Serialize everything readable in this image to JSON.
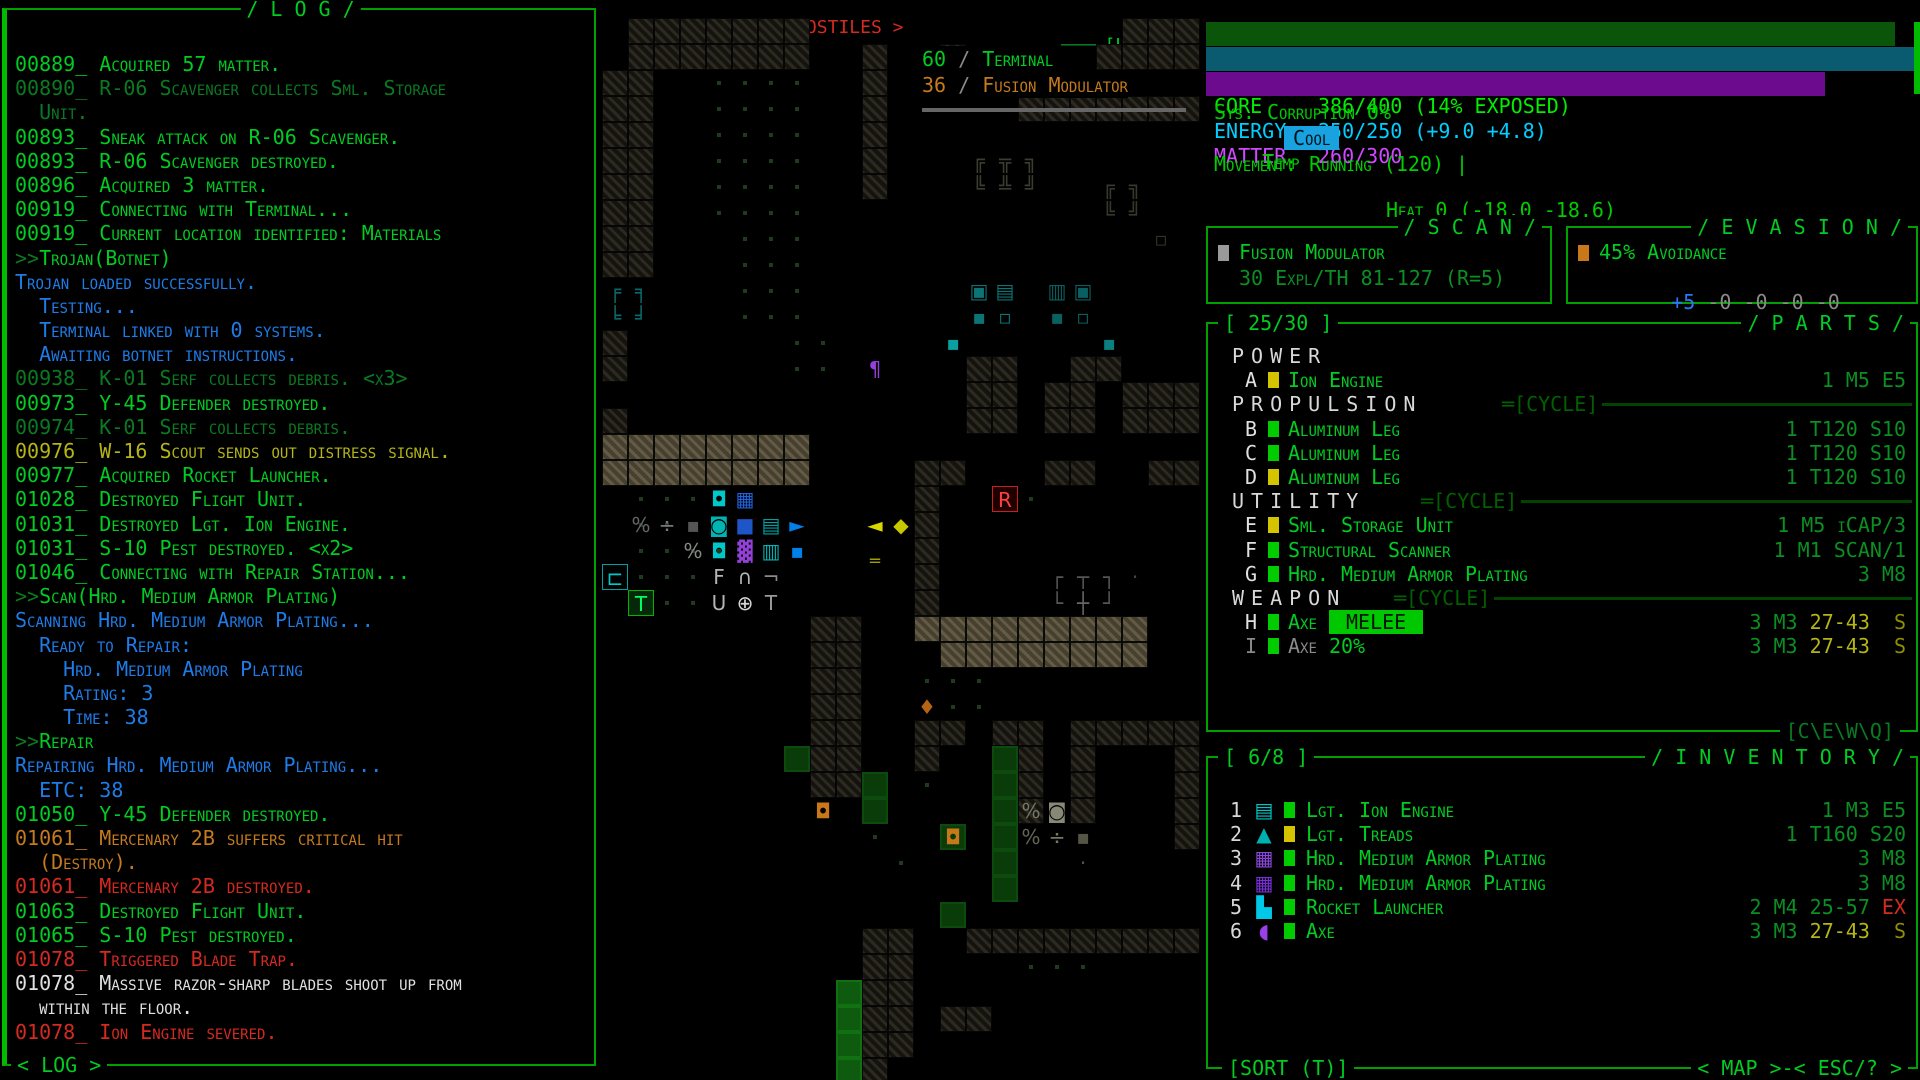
{
  "colors": {
    "green_bright": "#00cc22",
    "green_dim": "#0a7a22",
    "green_border": "#00a000",
    "blue": "#1e7ce8",
    "yellow": "#b5b517",
    "orange": "#c57a1e",
    "red": "#d42a20",
    "white": "#e0e0e0",
    "cyan": "#00c8c8",
    "purple": "#9340d8",
    "core_bar": "#0b550b",
    "energy_bar": "#0a5a70",
    "matter_bar": "#6d0b8e",
    "temp_chip_bg": "#18a2e0",
    "melee_chip_bg": "#00c800"
  },
  "log": {
    "title": "/ L O G /",
    "footer": "< LOG >",
    "lines": [
      [
        [
          "00889_ Acquired 57 matter.",
          "g"
        ]
      ],
      [
        [
          "00890_ R-06 Scavenger collects Sml. Storage",
          "d"
        ]
      ],
      [
        [
          "  Unit.",
          "d"
        ]
      ],
      [
        [
          "00893_ Sneak attack on R-06 Scavenger.",
          "g"
        ]
      ],
      [
        [
          "00893_ R-06 Scavenger destroyed.",
          "g"
        ]
      ],
      [
        [
          "00896_ Acquired 3 matter.",
          "g"
        ]
      ],
      [
        [
          "00919_ Connecting with Terminal...",
          "g"
        ]
      ],
      [
        [
          "00919_ Current location identified: Materials",
          "g"
        ]
      ],
      [
        [
          ">>",
          "d"
        ],
        [
          "Trojan(Botnet)",
          "g"
        ]
      ],
      [
        [
          "Trojan loaded successfully.",
          "b"
        ]
      ],
      [
        [
          "  Testing...",
          "b"
        ]
      ],
      [
        [
          "  Terminal linked with 0 systems.",
          "b"
        ]
      ],
      [
        [
          "  Awaiting botnet instructions.",
          "b"
        ]
      ],
      [
        [
          "00938_ K-01 Serf collects debris. <x3>",
          "d"
        ]
      ],
      [
        [
          "00973_ Y-45 Defender destroyed.",
          "g"
        ]
      ],
      [
        [
          "00974_ K-01 Serf collects debris.",
          "d"
        ]
      ],
      [
        [
          "00976_ W-16 Scout sends out distress signal.",
          "y"
        ]
      ],
      [
        [
          "00977_ Acquired Rocket Launcher.",
          "g"
        ]
      ],
      [
        [
          "01028_ Destroyed Flight Unit.",
          "g"
        ]
      ],
      [
        [
          "01031_ Destroyed Lgt. Ion Engine.",
          "g"
        ]
      ],
      [
        [
          "01031_ S-10 Pest destroyed. <x2>",
          "g"
        ]
      ],
      [
        [
          "01046_ Connecting with Repair Station...",
          "g"
        ]
      ],
      [
        [
          ">>",
          "d"
        ],
        [
          "Scan(Hrd. Medium Armor Plating)",
          "g"
        ]
      ],
      [
        [
          "Scanning Hrd. Medium Armor Plating...",
          "b"
        ]
      ],
      [
        [
          "  Ready to Repair:",
          "b"
        ]
      ],
      [
        [
          "    Hrd. Medium Armor Plating",
          "b"
        ]
      ],
      [
        [
          "    Rating: 3",
          "b"
        ]
      ],
      [
        [
          "    Time: 38",
          "b"
        ]
      ],
      [
        [
          ">>",
          "d"
        ],
        [
          "Repair",
          "g"
        ]
      ],
      [
        [
          "Repairing Hrd. Medium Armor Plating...",
          "b"
        ]
      ],
      [
        [
          "  ETC: 38",
          "b"
        ]
      ],
      [
        [
          "01050_ Y-45 Defender destroyed.",
          "g"
        ]
      ],
      [
        [
          "01061_ Mercenary 2B suffers critical hit",
          "o"
        ]
      ],
      [
        [
          "  (Destroy).",
          "o"
        ]
      ],
      [
        [
          "01061_ Mercenary 2B destroyed.",
          "r"
        ]
      ],
      [
        [
          "01063_ Destroyed Flight Unit.",
          "g"
        ]
      ],
      [
        [
          "01065_ S-10 Pest destroyed.",
          "g"
        ]
      ],
      [
        [
          "01078_ Triggered Blade Trap.",
          "r"
        ]
      ],
      [
        [
          "01078_ Massive razor-sharp blades shoot up from",
          "w"
        ]
      ],
      [
        [
          "  within the floor.",
          "w"
        ]
      ],
      [
        [
          "01078_ Ion Engine severed.",
          "r"
        ]
      ]
    ]
  },
  "map": {
    "header": {
      "zoom": "< ZOOM >",
      "dash": "-",
      "hostiles": "< 2 HOSTILES >",
      "laic": "[L\\A\\I\\C]"
    },
    "labels": {
      "terminal_num": "60",
      "slash1": "/",
      "terminal": "Terminal",
      "fusion_num": "36",
      "slash2": "/",
      "fusion": "Fusion Modulator"
    },
    "tiles": {
      "legend": {
        "#": "wall",
        "%": "wall-bright",
        ".": "floor-dot",
        "g": "green-tile",
        "G": "green-tile-bright"
      },
      "rows": [
        " #######            ###",
        " #######  #  #     ####",
        "##  ....  #            ",
        "##  ....  #     #######",
        "##  ....  #            ",
        "##  ....  #            ",
        "##  ....  #            ",
        "##  ....               ",
        "##   ...               ",
        "##   ...               ",
        "     ...               ",
        "     ...               ",
        "#      ..              ",
        "#      ..     ##  ##   ",
        "              ## ## ###",
        "#             ## ## ###",
        "%%%%%%%%               ",
        "%%%%%%%%    ##   ##  ##",
        " ...        #   .      ",
        " ....       #          ",
        " ....       #          ",
        " ...        #          ",
        "  ..        #          ",
        "        ##  %%%%%%%%%  ",
        "        ##   %%%%%%%%  ",
        "        ##  ...        ",
        "        ##  ...        ",
        "        ##  ## ## #####",
        "       g##  #  g# #   #",
        "        ##g .  g# #   #",
        "          g    g#.#   #",
        "          .  g g      #",
        "           .   g       ",
        "               g       ",
        "             g         ",
        "          ##  #########",
        "          ##    ...    ",
        "         G##           ",
        "         G## ##        ",
        "         G##           ",
        "         G#            "
      ]
    },
    "entities": [
      [
        14,
        5,
        "╔",
        "#3c3c30"
      ],
      [
        15,
        5,
        "╦",
        "#3c3c30"
      ],
      [
        16,
        5,
        "╗",
        "#3c3c30"
      ],
      [
        14,
        6,
        "╚",
        "#3c3c30"
      ],
      [
        15,
        6,
        "╩",
        "#3c3c30"
      ],
      [
        16,
        6,
        "╝",
        "#3c3c30"
      ],
      [
        19,
        6,
        "╔",
        "#38382c"
      ],
      [
        20,
        6,
        "╗",
        "#38382c"
      ],
      [
        19,
        7,
        "╚",
        "#38382c"
      ],
      [
        20,
        7,
        "╝",
        "#38382c"
      ],
      [
        21,
        8,
        "▫",
        "#33332a"
      ],
      [
        0,
        10,
        "╒",
        "#0b6868"
      ],
      [
        1,
        10,
        "╕",
        "#0b6868"
      ],
      [
        0,
        11,
        "╘",
        "#0b6868"
      ],
      [
        1,
        11,
        "╛",
        "#0b6868"
      ],
      [
        14,
        10,
        "▣",
        "#0c7474"
      ],
      [
        15,
        10,
        "▤",
        "#0c7474"
      ],
      [
        17,
        10,
        "▥",
        "#0a6060"
      ],
      [
        18,
        10,
        "▣",
        "#0a6060"
      ],
      [
        14,
        11,
        "▪",
        "#0c7474"
      ],
      [
        15,
        11,
        "▫",
        "#0c7474"
      ],
      [
        17,
        11,
        "▪",
        "#0a6060"
      ],
      [
        18,
        11,
        "▫",
        "#0a6060"
      ],
      [
        19,
        12,
        "▪",
        "#0b8080"
      ],
      [
        13,
        12,
        "▪",
        "#0aa0a0"
      ],
      [
        10,
        13,
        "¶",
        "#9340d8"
      ],
      [
        1,
        19,
        "%",
        "#666666"
      ],
      [
        2,
        19,
        "÷",
        "#777777"
      ],
      [
        3,
        19,
        "▪",
        "#555555"
      ],
      [
        4,
        18,
        "◘",
        "#00c8c8"
      ],
      [
        5,
        18,
        "▦",
        "#2060d8"
      ],
      [
        4,
        19,
        "◙",
        "#00b4b4"
      ],
      [
        5,
        19,
        "■",
        "#1e56c8"
      ],
      [
        6,
        19,
        "▤",
        "#00a0a0"
      ],
      [
        7,
        19,
        "►",
        "#0080e8"
      ],
      [
        3,
        20,
        "%",
        "#888888"
      ],
      [
        4,
        20,
        "◘",
        "#00c8c8"
      ],
      [
        5,
        20,
        "▓",
        "#9340d8"
      ],
      [
        6,
        20,
        "▥",
        "#00b4b4"
      ],
      [
        7,
        20,
        "▪",
        "#0080e8"
      ],
      [
        10,
        19,
        "◄",
        "#d8d800"
      ],
      [
        11,
        19,
        "◆",
        "#c8c800"
      ],
      [
        10,
        20,
        "‗",
        "#a0a000"
      ],
      [
        15,
        18,
        "R",
        "#ff4040",
        "#1e0000",
        "#c82020",
        "hostile-robot"
      ],
      [
        0,
        21,
        "⊏",
        "#00c8c8",
        null,
        "#00a0a0",
        "machine-access-tile"
      ],
      [
        1,
        22,
        "T",
        "#00ff60",
        "#06280a",
        "#00b400",
        "terminal-tile"
      ],
      [
        4,
        21,
        "F",
        "#b4b4b4"
      ],
      [
        5,
        21,
        "∩",
        "#b4b4b4"
      ],
      [
        6,
        21,
        "¬",
        "#8a8a8a"
      ],
      [
        4,
        22,
        "U",
        "#b4b4b4"
      ],
      [
        5,
        22,
        "⊕",
        "#d8d8d8",
        null,
        null,
        "targeting-cursor"
      ],
      [
        6,
        22,
        "T",
        "#9a9a9a"
      ],
      [
        17,
        21,
        "┌",
        "#555555"
      ],
      [
        18,
        21,
        "┬",
        "#555555"
      ],
      [
        19,
        21,
        "┐",
        "#555555"
      ],
      [
        20,
        21,
        "·",
        "#444444"
      ],
      [
        17,
        22,
        "└",
        "#555555"
      ],
      [
        18,
        22,
        "┼",
        "#666666"
      ],
      [
        19,
        22,
        "┘",
        "#555555"
      ],
      [
        12,
        26,
        "♦",
        "#b46414"
      ],
      [
        8,
        30,
        "◘",
        "#c87818"
      ],
      [
        13,
        31,
        "◘",
        "#c87818"
      ],
      [
        16,
        30,
        "%",
        "#777766"
      ],
      [
        17,
        30,
        "◙",
        "#888877"
      ],
      [
        16,
        31,
        "%",
        "#666655"
      ],
      [
        17,
        31,
        "÷",
        "#777766"
      ],
      [
        18,
        31,
        "▪",
        "#555544"
      ],
      [
        18,
        32,
        "·",
        "#555544"
      ]
    ]
  },
  "status": {
    "core_label": "CORE",
    "core_value": "386/400 (14% EXPOSED)",
    "core_fill_pct": 96.5,
    "energy_label": "ENERGY",
    "energy_value": "250/250 (+9.0 +4.8)",
    "energy_fill_pct": 100,
    "matter_label": "MATTER",
    "matter_value": "260/300",
    "matter_fill_pct": 86.7,
    "sys": "Sys. Corruption 0%",
    "temp_label": "Temp",
    "temp_chip": "Cool",
    "temp_rest": "Heat 0 (-18.0 -18.6)",
    "movement": "Movement: Running (120) |",
    "time_label": "Time:",
    "time_value": "1144",
    "loc_label": "Loc:",
    "loc_value": "-9/Materials"
  },
  "scan": {
    "title": "/ S C A N /",
    "item": "Fusion Modulator",
    "detail": "30 Expl/TH 81-127 (R=5)"
  },
  "evasion": {
    "title": "/ E V A S I O N /",
    "line1": "45% Avoidance",
    "plus": "+5",
    "minuses": " -0 -0 -0 -0"
  },
  "parts": {
    "count": "[ 25/30 ]",
    "title": "/ P A R T S /",
    "footer": "[C\\E\\W\\Q]",
    "rows": [
      {
        "type": "section",
        "label": "POWER",
        "cycle": ""
      },
      {
        "type": "item",
        "slot": "A",
        "slot_c": "w",
        "block": "#d4c400",
        "name": [
          [
            "Ion Engine",
            "g"
          ]
        ],
        "stats": [
          [
            "1 M5 E5",
            "s"
          ]
        ]
      },
      {
        "type": "section",
        "label": "PROPULSION",
        "cycle": "═[CYCLE]"
      },
      {
        "type": "item",
        "slot": "B",
        "slot_c": "w",
        "block": "#00cc00",
        "name": [
          [
            "Aluminum Leg",
            "g"
          ]
        ],
        "stats": [
          [
            "1 T120 S10",
            "s"
          ]
        ]
      },
      {
        "type": "item",
        "slot": "C",
        "slot_c": "w",
        "block": "#00cc00",
        "name": [
          [
            "Aluminum Leg",
            "g"
          ]
        ],
        "stats": [
          [
            "1 T120 S10",
            "s"
          ]
        ]
      },
      {
        "type": "item",
        "slot": "D",
        "slot_c": "w",
        "block": "#d4c400",
        "name": [
          [
            "Aluminum Leg",
            "g"
          ]
        ],
        "stats": [
          [
            "1 T120 S10",
            "s"
          ]
        ]
      },
      {
        "type": "section",
        "label": "UTILITY",
        "cycle": "═[CYCLE]"
      },
      {
        "type": "item",
        "slot": "E",
        "slot_c": "w",
        "block": "#d4c400",
        "name": [
          [
            "Sml. Storage Unit",
            "g"
          ]
        ],
        "stats": [
          [
            "1 M5 iCAP/3",
            "s"
          ]
        ]
      },
      {
        "type": "item",
        "slot": "F",
        "slot_c": "w",
        "block": "#00cc00",
        "name": [
          [
            "Structural Scanner",
            "g"
          ]
        ],
        "stats": [
          [
            "1 M1 SCAN/1",
            "s"
          ]
        ]
      },
      {
        "type": "item",
        "slot": "G",
        "slot_c": "w",
        "block": "#00cc00",
        "name": [
          [
            "Hrd. Medium Armor Plating",
            "g"
          ]
        ],
        "stats": [
          [
            "3 M8",
            "s"
          ]
        ]
      },
      {
        "type": "section",
        "label": "WEAPON",
        "cycle": "═[CYCLE]"
      },
      {
        "type": "item",
        "slot": "H",
        "slot_c": "w",
        "block": "#00cc00",
        "name": [
          [
            "Axe ",
            "g"
          ],
          [
            " MELEE ",
            "chip"
          ]
        ],
        "stats": [
          [
            "3 M3 ",
            "s"
          ],
          [
            "27-43",
            "y"
          ],
          [
            "  S",
            "dy"
          ]
        ]
      },
      {
        "type": "item",
        "slot": "I",
        "slot_c": "gr",
        "block": "#00cc00",
        "name": [
          [
            "Axe ",
            "gr"
          ],
          [
            "20%",
            "g"
          ]
        ],
        "stats": [
          [
            "3 M3 ",
            "s"
          ],
          [
            "27-43",
            "y"
          ],
          [
            "  S",
            "dy"
          ]
        ]
      }
    ]
  },
  "inventory": {
    "count": "[ 6/8 ]",
    "title": "/ I N V E N T O R Y /",
    "footer_left": "[SORT (T)]",
    "footer_right": "< MAP >-< ESC/? >",
    "rows": [
      {
        "num": "1",
        "icon": "▤",
        "icon_c": "#00c8c8",
        "icon_name": "ion-engine-icon",
        "block": "#00cc00",
        "name": [
          [
            "Lgt. Ion Engine",
            "g"
          ]
        ],
        "stats": [
          [
            "1 M3 E5",
            "s"
          ]
        ]
      },
      {
        "num": "2",
        "icon": "▲",
        "icon_c": "#00b0b0",
        "icon_name": "treads-icon",
        "block": "#d4c400",
        "name": [
          [
            "Lgt. Treads",
            "g"
          ]
        ],
        "stats": [
          [
            "1 T160 S20",
            "s"
          ]
        ]
      },
      {
        "num": "3",
        "icon": "▦",
        "icon_c": "#8c46e0",
        "icon_name": "armor-plating-icon",
        "block": "#00cc00",
        "name": [
          [
            "Hrd. Medium Armor Plating",
            "g"
          ]
        ],
        "stats": [
          [
            "3 M8",
            "s"
          ]
        ]
      },
      {
        "num": "4",
        "icon": "▦",
        "icon_c": "#7a30d8",
        "icon_name": "armor-plating-icon",
        "block": "#00cc00",
        "name": [
          [
            "Hrd. Medium Armor Plating",
            "g"
          ]
        ],
        "stats": [
          [
            "3 M8",
            "s"
          ]
        ]
      },
      {
        "num": "5",
        "icon": "▙",
        "icon_c": "#00c8e8",
        "icon_name": "rocket-launcher-icon",
        "block": "#00cc00",
        "name": [
          [
            "Rocket Launcher",
            "g"
          ]
        ],
        "stats": [
          [
            "2 M4 25-57 ",
            "s"
          ],
          [
            "EX",
            "r"
          ]
        ]
      },
      {
        "num": "6",
        "icon": "◖",
        "icon_c": "#9a40e8",
        "icon_name": "axe-icon",
        "block": "#00cc00",
        "name": [
          [
            "Axe",
            "g"
          ]
        ],
        "stats": [
          [
            "3 M3 ",
            "s"
          ],
          [
            "27-43",
            "y"
          ],
          [
            "  S",
            "dy"
          ]
        ]
      }
    ]
  }
}
